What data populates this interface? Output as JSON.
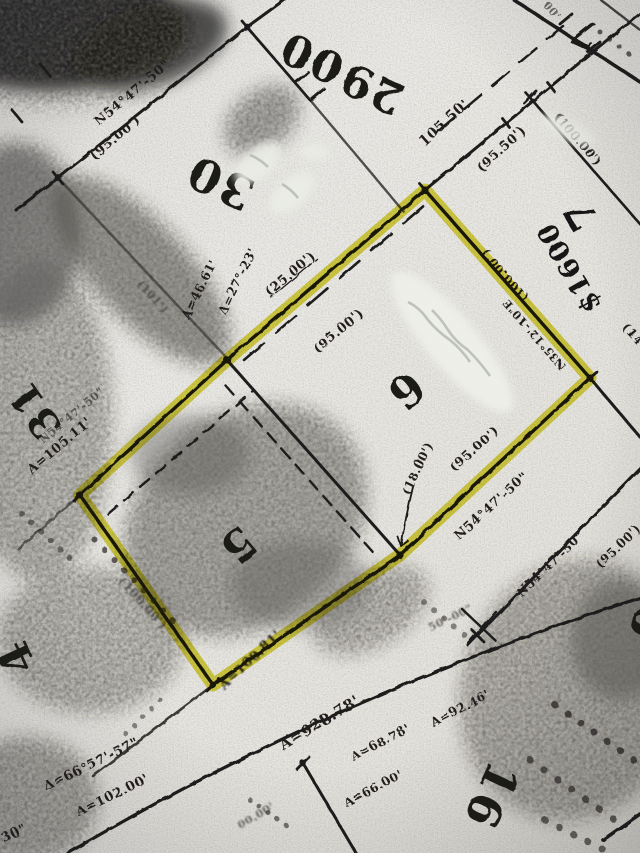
{
  "meta": {
    "description": "Photocopied subdivision plat map; lots 5 and 6 outlined in yellow highlighter; handwritten price annotation",
    "paper_color": "#e9e8e4",
    "ink_color": "#1e1d1b",
    "highlight_color": "#ddd634",
    "whiteout_color": "#edefe8"
  },
  "highlighted_parcels": [
    "5",
    "6"
  ],
  "lot_numbers": [
    {
      "name": "lot-number-29",
      "text": "29",
      "x": 378,
      "y": 74,
      "rot": -155,
      "size": 44
    },
    {
      "name": "lot-number-fragment-00",
      "text": "00",
      "x": 318,
      "y": 44,
      "rot": -155,
      "size": 44
    },
    {
      "name": "lot-number-30",
      "text": "30",
      "x": 227,
      "y": 168,
      "rot": -155,
      "size": 46
    },
    {
      "name": "lot-number-31",
      "text": "31",
      "x": 46,
      "y": 402,
      "rot": -125,
      "size": 40
    },
    {
      "name": "lot-number-4",
      "text": "4",
      "x": 30,
      "y": 651,
      "rot": -115,
      "size": 44
    },
    {
      "name": "lot-number-5",
      "text": "5",
      "x": 228,
      "y": 534,
      "rot": 140,
      "size": 44
    },
    {
      "name": "lot-number-6",
      "text": "6",
      "x": 396,
      "y": 379,
      "rot": 140,
      "size": 44
    },
    {
      "name": "lot-number-16",
      "text": "16",
      "x": 477,
      "y": 789,
      "rot": 115,
      "size": 46
    },
    {
      "name": "lot-number-6-right",
      "text": "6",
      "x": 634,
      "y": 617,
      "rot": 115,
      "size": 50
    },
    {
      "name": "lot-number-7-top",
      "text": "7",
      "x": 590,
      "y": 21,
      "rot": -155,
      "size": 38
    }
  ],
  "annotations": [
    {
      "name": "price-annotation",
      "text": "$1600",
      "x": 577,
      "y": 263,
      "rot": -120,
      "size": 27
    },
    {
      "name": "lot-7-annotation",
      "text": "7",
      "x": 593,
      "y": 208,
      "rot": -120,
      "size": 40
    }
  ],
  "dimension_labels": [
    {
      "name": "bearing-lot30-nw",
      "text": "N54°47'-50\"",
      "x": 135,
      "y": 96,
      "rot": -40,
      "size": 13,
      "cls": ""
    },
    {
      "name": "dist-lot30-nw",
      "text": "(95.00')",
      "x": 118,
      "y": 141,
      "rot": -40,
      "size": 13,
      "cls": ""
    },
    {
      "name": "dist-road-105",
      "text": "105.50'",
      "x": 447,
      "y": 126,
      "rot": -42,
      "size": 14,
      "cls": ""
    },
    {
      "name": "dist-road-95",
      "text": "(95.50')",
      "x": 504,
      "y": 152,
      "rot": -42,
      "size": 13,
      "cls": ""
    },
    {
      "name": "dist-25",
      "text": "(25.00')",
      "x": 293,
      "y": 277,
      "rot": -40,
      "size": 13,
      "cls": "u"
    },
    {
      "name": "dist-lot6-nw",
      "text": "(95.00')",
      "x": 341,
      "y": 334,
      "rot": -40,
      "size": 13,
      "cls": ""
    },
    {
      "name": "dist-lot6-ne",
      "text": "(100.00')",
      "x": 508,
      "y": 273,
      "rot": -131,
      "size": 12,
      "cls": ""
    },
    {
      "name": "bearing-lot6-ne",
      "text": "N35°12'-10\"E",
      "x": 537,
      "y": 332,
      "rot": -131,
      "size": 11,
      "cls": ""
    },
    {
      "name": "dist-lot6-se",
      "text": "(95.00')",
      "x": 477,
      "y": 452,
      "rot": -42,
      "size": 13,
      "cls": ""
    },
    {
      "name": "bearing-lot6-se",
      "text": "N54°47'-50\"",
      "x": 494,
      "y": 509,
      "rot": -42,
      "size": 13,
      "cls": ""
    },
    {
      "name": "dist-18",
      "text": "(18.00')",
      "x": 421,
      "y": 470,
      "rot": -65,
      "size": 12,
      "cls": ""
    },
    {
      "name": "bearing-block16",
      "text": "N54°47'-50\"",
      "x": 553,
      "y": 567,
      "rot": -44,
      "size": 12,
      "cls": ""
    },
    {
      "name": "dist-block16",
      "text": "(95.00')",
      "x": 621,
      "y": 549,
      "rot": -44,
      "size": 12,
      "cls": ""
    },
    {
      "name": "bearing-lot31",
      "text": "N54°47'-50\"",
      "x": 74,
      "y": 418,
      "rot": -40,
      "size": 11,
      "cls": "faded"
    },
    {
      "name": "arc-lot31",
      "text": "A=105.11'",
      "x": 62,
      "y": 449,
      "rot": -40,
      "size": 13,
      "cls": ""
    },
    {
      "name": "arc-lot5-se",
      "text": "A=100.81'",
      "x": 253,
      "y": 663,
      "rot": -43,
      "size": 13,
      "cls": "blur"
    },
    {
      "name": "dist-lot5-sw",
      "text": "(100.00')",
      "x": 140,
      "y": 606,
      "rot": 48,
      "size": 12,
      "cls": "blur faded"
    },
    {
      "name": "arc-road-928",
      "text": "A=928.78'",
      "x": 322,
      "y": 727,
      "rot": -31,
      "size": 15,
      "cls": ""
    },
    {
      "name": "delta-road",
      "text": "Δ=66°57'-57\"",
      "x": 93,
      "y": 768,
      "rot": -26,
      "size": 13,
      "cls": ""
    },
    {
      "name": "arc-road-102",
      "text": "A=102.00'",
      "x": 114,
      "y": 799,
      "rot": -26,
      "size": 13,
      "cls": ""
    },
    {
      "name": "arc-lot16-a",
      "text": "A=68.78'",
      "x": 382,
      "y": 746,
      "rot": -28,
      "size": 12,
      "cls": ""
    },
    {
      "name": "arc-lot16-b",
      "text": "A=66.00'",
      "x": 375,
      "y": 792,
      "rot": -28,
      "size": 12,
      "cls": ""
    },
    {
      "name": "arc-lot16-c",
      "text": "A=92.46'",
      "x": 462,
      "y": 712,
      "rot": -27,
      "size": 12,
      "cls": ""
    },
    {
      "name": "frag-corner-30s",
      "text": "30\"",
      "x": 16,
      "y": 837,
      "rot": -26,
      "size": 13,
      "cls": ""
    },
    {
      "name": "dist-lot7-ne",
      "text": "(100.00')",
      "x": 575,
      "y": 142,
      "rot": 49,
      "size": 12,
      "cls": ""
    },
    {
      "name": "frag-top-00",
      "text": "00'",
      "x": 549,
      "y": 13,
      "rot": 49,
      "size": 11,
      "cls": "faded"
    },
    {
      "name": "frag-right-14",
      "text": "(14",
      "x": 630,
      "y": 337,
      "rot": 49,
      "size": 12,
      "cls": ""
    },
    {
      "name": "arc-corner-f",
      "text": "A=46.61'",
      "x": 203,
      "y": 291,
      "rot": -64,
      "size": 12,
      "cls": ""
    },
    {
      "name": "delta-corner-f",
      "text": "Δ=27°-23'",
      "x": 241,
      "y": 283,
      "rot": -64,
      "size": 12,
      "cls": ""
    },
    {
      "name": "frag-101",
      "text": "(101')",
      "x": 150,
      "y": 299,
      "rot": 48,
      "size": 11,
      "cls": "faded blur"
    },
    {
      "name": "frag-50-00",
      "text": "50'-00\"",
      "x": 452,
      "y": 621,
      "rot": -26,
      "size": 11,
      "cls": "faded blur"
    },
    {
      "name": "frag-00-00",
      "text": "00.00'",
      "x": 258,
      "y": 819,
      "rot": -31,
      "size": 11,
      "cls": "faded blur"
    }
  ]
}
